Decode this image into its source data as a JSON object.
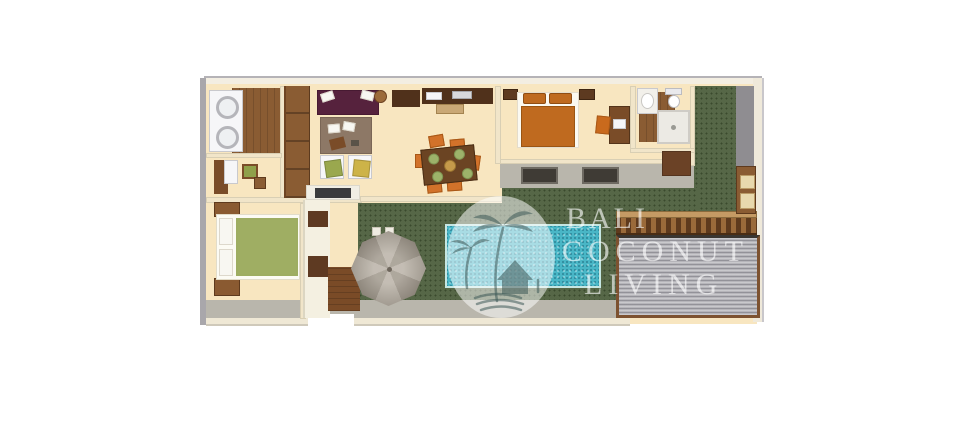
{
  "watermark": {
    "lines": [
      "BALI",
      "COCONUT",
      "LIVING"
    ],
    "text_color": "rgba(255,255,255,0.62)",
    "logo_icons": [
      "palm-tree-icon",
      "beach-hut-icon",
      "waves-icon"
    ]
  },
  "colors": {
    "background": "#ffffff",
    "floor": "#f8e6c0",
    "lawn": "#4d5f3d",
    "terrace": "#b9b6ac",
    "pool": "#49b6c6",
    "wood": "#8a5c33",
    "wood_dark": "#7a4b27",
    "counter_dark": "#50311b",
    "sofa": "#56223d",
    "rug": "#8d7866",
    "dining_table": "#6b4423",
    "chair_orange": "#d2722a",
    "bed_master": "#bf6a1f",
    "bed_guest": "#9fae63",
    "umbrella": "#aba294",
    "roof": "#b6b5ba"
  }
}
